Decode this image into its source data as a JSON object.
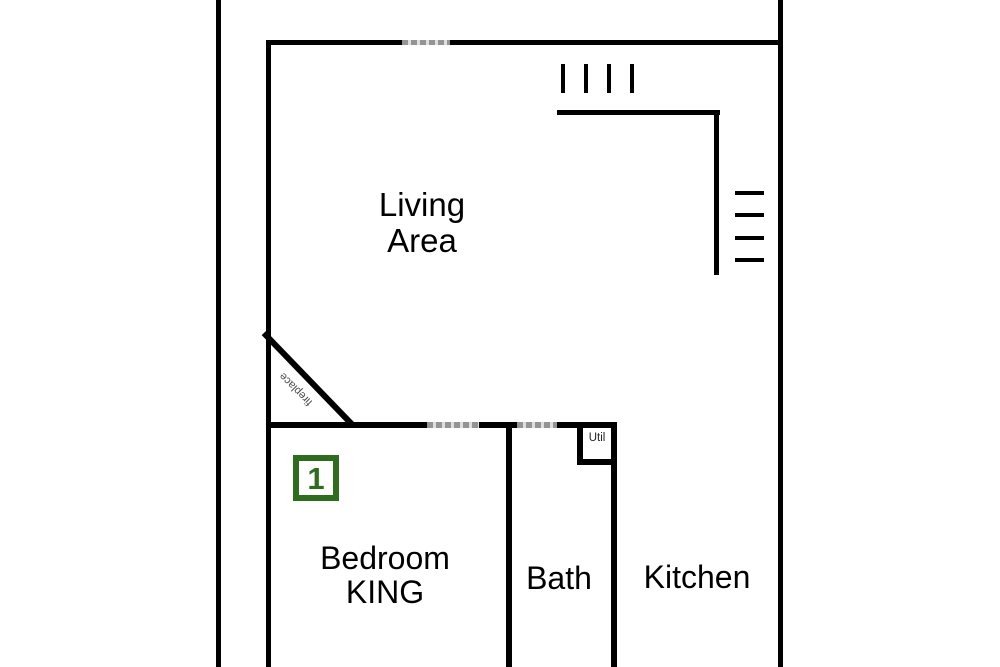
{
  "palette": {
    "wall": "#000000",
    "door_dash": "#949494",
    "unit_green": "#2e6d1e",
    "label_text": "#000000",
    "fireplace_text": "#4a4a4a"
  },
  "areas": {
    "deck": {
      "label": "Deck"
    },
    "living": {
      "line1": "Living",
      "line2": "Area"
    },
    "bedroom": {
      "line1": "Bedroom",
      "line2": "KING",
      "unit_number": "1"
    },
    "bath": {
      "label": "Bath"
    },
    "kitchen": {
      "label": "Kitchen"
    },
    "util": {
      "label": "Util"
    },
    "fireplace": {
      "label": "fireplace"
    }
  }
}
